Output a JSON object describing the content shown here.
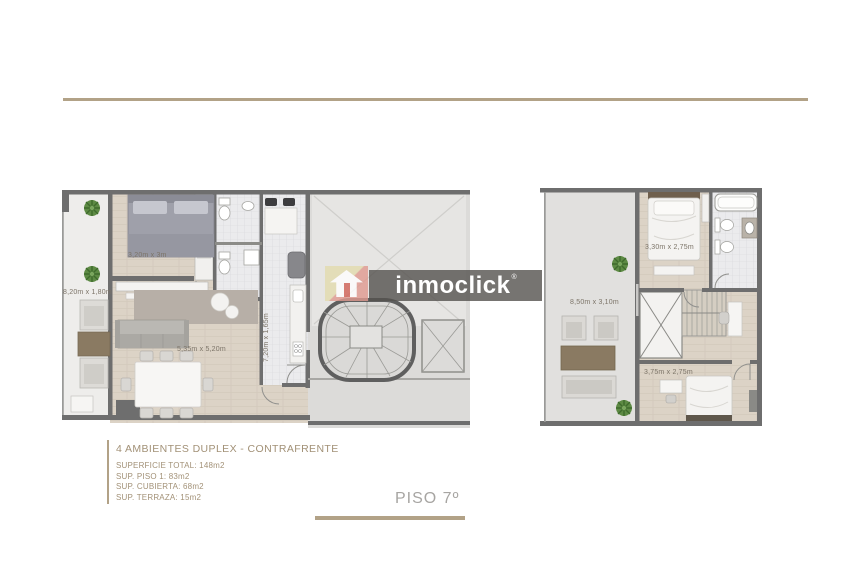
{
  "info": {
    "title": "4 AMBIENTES DUPLEX - CONTRAFRENTE",
    "specs": [
      "SUPERFICIE TOTAL: 148m2",
      "SUP. PISO 1: 83m2",
      "SUP. CUBIERTA: 68m2",
      "SUP. TERRAZA: 15m2"
    ],
    "floor_label": "PISO 7º",
    "accent_color": "#b2a287"
  },
  "watermark": {
    "brand": "inmoclick",
    "registered": "®",
    "icon": "house-arrow-icon",
    "box_color": "#54514e",
    "text_color": "#ffffff"
  },
  "dims": {
    "f1_bedroom": "3,20m x 3m",
    "f1_balcony": "8,20m x 1,80m",
    "f1_living": "5,35m x 5,20m",
    "f1_kitchen": "7,20m x 1,65m",
    "f2_bedroom2": "3,30m x 2,75m",
    "f2_terrace": "8,50m x 3,10m",
    "f2_bedroom3": "3,75m x 2,75m"
  }
}
